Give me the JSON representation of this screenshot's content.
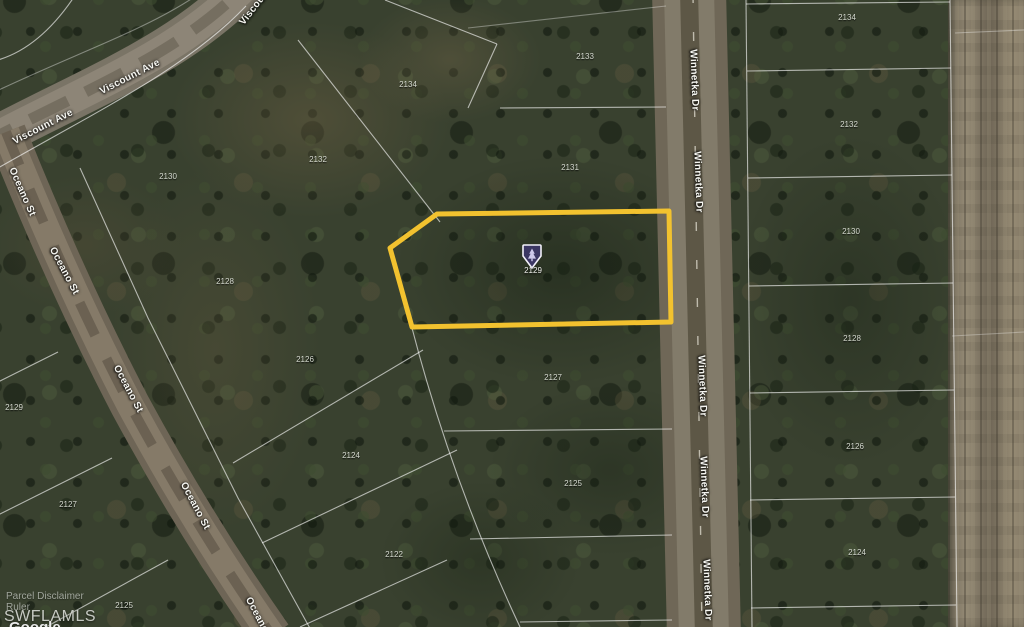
{
  "map_type": "satellite-parcel-map",
  "colors": {
    "highlight_outline": "#F2C22F",
    "marker_fill": "#3B3663",
    "marker_border": "#F2F0FA",
    "parcel_line": "#FFFFFF"
  },
  "roads": {
    "viscount": {
      "name": "Viscount Ave",
      "labels": [
        {
          "text": "Viscount Ave",
          "x": 130,
          "y": 77,
          "rot": -27
        },
        {
          "text": "Viscount Ave",
          "x": 43,
          "y": 127,
          "rot": -27
        },
        {
          "text": "Viscount Ave",
          "x": 262,
          "y": -2,
          "rot": -52
        }
      ]
    },
    "oceano": {
      "name": "Oceano St",
      "labels": [
        {
          "text": "Oceano St",
          "x": 22,
          "y": 192,
          "rot": 66
        },
        {
          "text": "Oceano St",
          "x": 64,
          "y": 271,
          "rot": 62
        },
        {
          "text": "Oceano St",
          "x": 128,
          "y": 389,
          "rot": 62
        },
        {
          "text": "Oceano St",
          "x": 195,
          "y": 506,
          "rot": 62
        },
        {
          "text": "Oceano St",
          "x": 260,
          "y": 621,
          "rot": 62
        }
      ]
    },
    "winnetka": {
      "name": "Winnetka Dr",
      "labels": [
        {
          "text": "Winnetka Dr",
          "x": 694,
          "y": 80,
          "rot": 88
        },
        {
          "text": "Winnetka Dr",
          "x": 698,
          "y": 182,
          "rot": 88
        },
        {
          "text": "Winnetka Dr",
          "x": 702,
          "y": 386,
          "rot": 88
        },
        {
          "text": "Winnetka Dr",
          "x": 704,
          "y": 487,
          "rot": 88
        },
        {
          "text": "Winnetka Dr",
          "x": 707,
          "y": 590,
          "rot": 88
        }
      ]
    }
  },
  "parcel_numbers": [
    {
      "text": "2130",
      "x": 168,
      "y": 177
    },
    {
      "text": "2132",
      "x": 318,
      "y": 160
    },
    {
      "text": "2134",
      "x": 408,
      "y": 85
    },
    {
      "text": "2133",
      "x": 585,
      "y": 57
    },
    {
      "text": "2131",
      "x": 570,
      "y": 168
    },
    {
      "text": "2128",
      "x": 225,
      "y": 282
    },
    {
      "text": "2126",
      "x": 305,
      "y": 360
    },
    {
      "text": "2124",
      "x": 351,
      "y": 456
    },
    {
      "text": "2122",
      "x": 394,
      "y": 555
    },
    {
      "text": "2127",
      "x": 553,
      "y": 378
    },
    {
      "text": "2125",
      "x": 573,
      "y": 484
    },
    {
      "text": "2129",
      "x": 14,
      "y": 408
    },
    {
      "text": "2127",
      "x": 68,
      "y": 505
    },
    {
      "text": "2125",
      "x": 124,
      "y": 606
    },
    {
      "text": "2134",
      "x": 847,
      "y": 18
    },
    {
      "text": "2132",
      "x": 849,
      "y": 125
    },
    {
      "text": "2130",
      "x": 851,
      "y": 232
    },
    {
      "text": "2128",
      "x": 852,
      "y": 339
    },
    {
      "text": "2126",
      "x": 855,
      "y": 447
    },
    {
      "text": "2124",
      "x": 857,
      "y": 553
    }
  ],
  "highlighted_parcel": {
    "number": "2129",
    "marker_label": "2129",
    "outline_color": "#F2C22F",
    "points": "390,248 437,214 669,211 671,322 412,327"
  },
  "watermarks": {
    "line1": "Parcel Disclaimer",
    "line2": "Ruler",
    "brand": "SWFLAMLS",
    "partner": "Google"
  }
}
